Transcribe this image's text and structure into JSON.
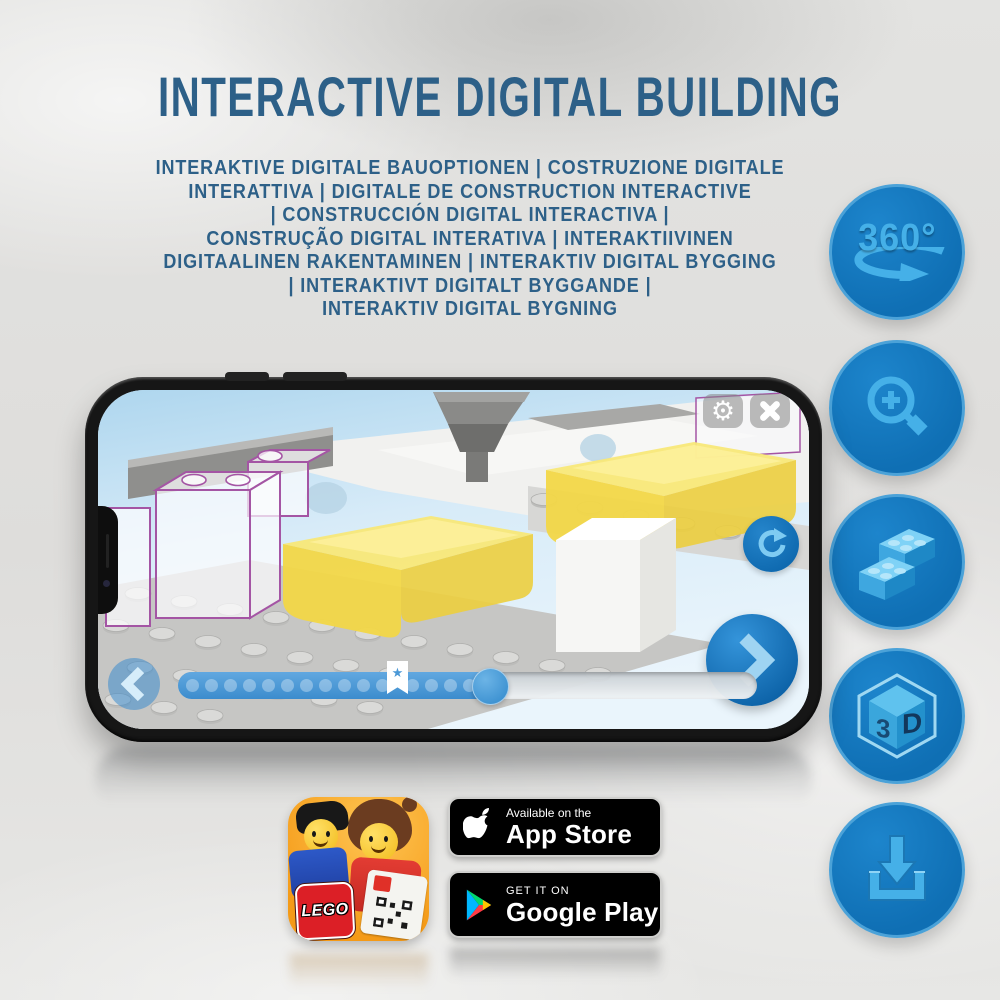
{
  "title": "INTERACTIVE DIGITAL BUILDING",
  "subtitle": {
    "lines": [
      "INTERAKTIVE DIGITALE BAUOPTIONEN | COSTRUZIONE DIGITALE",
      "INTERATTIVA | DIGITALE DE CONSTRUCTION INTERACTIVE",
      "| CONSTRUCCIÓN DIGITAL INTERACTIVA |",
      "CONSTRUÇÃO DIGITAL INTERATIVA | INTERAKTIIVINEN",
      "DIGITAALINEN RAKENTAMINEN | INTERAKTIV DIGITAL BYGGING",
      "| INTERAKTIVT DIGITALT BYGGANDE |",
      "INTERAKTIV DIGITAL BYGNING"
    ]
  },
  "features": {
    "rotate_360": {
      "label": "360°"
    },
    "zoom": {
      "name": "zoom-in-magnifier"
    },
    "bricks": {
      "name": "digital-lego-bricks"
    },
    "view_3d": {
      "left": "3",
      "right": "D"
    },
    "download": {
      "name": "download-instructions"
    }
  },
  "icons": {
    "gear": "⚙",
    "star": "★"
  },
  "app_icon": {
    "logo_text": "LEGO"
  },
  "store_badges": {
    "app_store": {
      "tagline": "Available on the",
      "name": "App Store"
    },
    "google_play": {
      "tagline": "GET IT ON",
      "name": "Google Play"
    }
  },
  "colors": {
    "title_blue": "#2d6088",
    "circle_blue": "#0f6fb4",
    "glyph_blue": "#45b0e8",
    "progress_blue": "#4c9ad8",
    "ghost_outline_purple": "#a455a4",
    "bench_yellow": "#f2d747"
  }
}
